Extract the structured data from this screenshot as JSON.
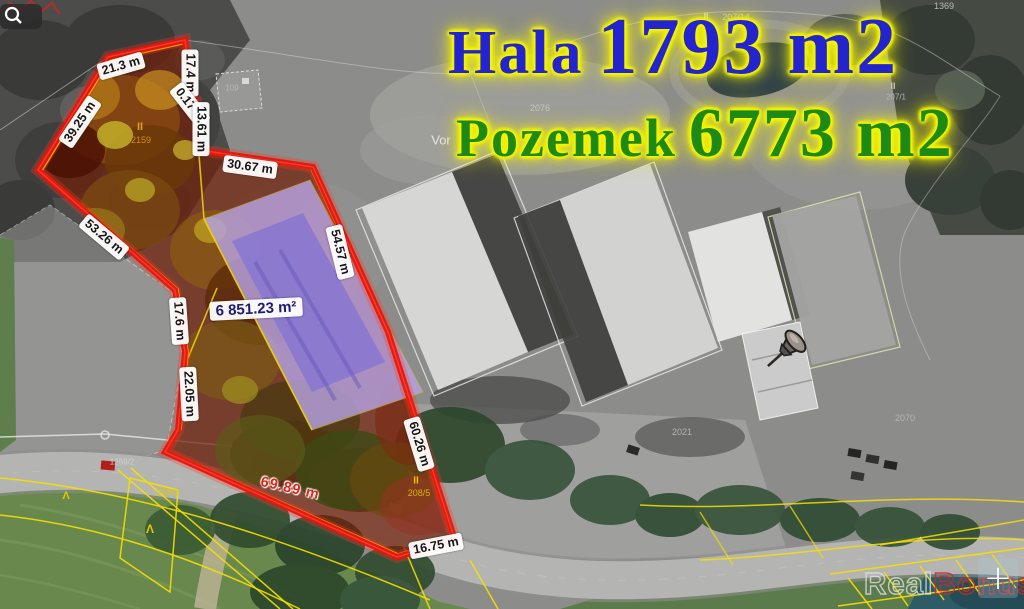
{
  "titles": {
    "hala_label": "Hala",
    "hala_value": "1793 m2",
    "pozemek_label": "Pozemek",
    "pozemek_value": "6773 m2"
  },
  "colors": {
    "hala_text": "#2424cf",
    "pozemek_text": "#1e8a16",
    "title_glow": "#f6f600",
    "boundary_red": "#e8140c",
    "cadastral_yellow": "#f5e000",
    "building_overlay_light": "#b6a2e2",
    "building_overlay_dark": "#8a78d0",
    "water_teal": "#2d5c66",
    "watermark_red": "#ce2824",
    "watermark_blue": "#2e60ba"
  },
  "measurements": [
    {
      "label": "21.3 m",
      "x": 121,
      "y": 66,
      "rot": -16,
      "style": "box"
    },
    {
      "label": "17.4 m",
      "x": 190,
      "y": 73,
      "rot": 90,
      "style": "box"
    },
    {
      "label": "0.17 m",
      "x": 190,
      "y": 105,
      "rot": 52,
      "style": "box"
    },
    {
      "label": "13.61 m",
      "x": 201,
      "y": 129,
      "rot": 90,
      "style": "box"
    },
    {
      "label": "39.25 m",
      "x": 80,
      "y": 122,
      "rot": -56,
      "style": "box"
    },
    {
      "label": "53.26 m",
      "x": 104,
      "y": 237,
      "rot": 40,
      "style": "box"
    },
    {
      "label": "30.67 m",
      "x": 250,
      "y": 167,
      "rot": 8,
      "style": "box"
    },
    {
      "label": "54.57 m",
      "x": 340,
      "y": 252,
      "rot": 76,
      "style": "box"
    },
    {
      "label": "17.6 m",
      "x": 179,
      "y": 321,
      "rot": 86,
      "style": "box"
    },
    {
      "label": "22.05 m",
      "x": 189,
      "y": 394,
      "rot": 87,
      "style": "box"
    },
    {
      "label": "60.26 m",
      "x": 419,
      "y": 444,
      "rot": 73,
      "style": "box"
    },
    {
      "label": "16.75 m",
      "x": 436,
      "y": 546,
      "rot": -11,
      "style": "box"
    },
    {
      "label": "69.89 m",
      "x": 290,
      "y": 489,
      "rot": 13,
      "style": "red"
    },
    {
      "label": "6 851.23 m²",
      "x": 256,
      "y": 309,
      "rot": -3,
      "style": "area"
    }
  ],
  "cadastral_labels": [
    {
      "text": "II",
      "x": 140,
      "y": 127,
      "color": "#e2a01a",
      "size": 11,
      "bold": true
    },
    {
      "text": "2159",
      "x": 141,
      "y": 140,
      "color": "#cc8c12",
      "size": 9,
      "bold": false
    },
    {
      "text": "II",
      "x": 706,
      "y": 16,
      "color": "#d8d8d6",
      "size": 9,
      "bold": true
    },
    {
      "text": "207/14",
      "x": 736,
      "y": 17,
      "color": "#c8c8c6",
      "size": 9,
      "bold": false
    },
    {
      "text": "1369",
      "x": 944,
      "y": 6,
      "color": "#b8b8b6",
      "size": 9,
      "bold": false
    },
    {
      "text": "II",
      "x": 893,
      "y": 86,
      "color": "#c8c8c6",
      "size": 9,
      "bold": true
    },
    {
      "text": "207/1",
      "x": 896,
      "y": 97,
      "color": "#b8b8b6",
      "size": 8,
      "bold": false
    },
    {
      "text": "109",
      "x": 232,
      "y": 88,
      "color": "#b8b8b6",
      "size": 8,
      "bold": false
    },
    {
      "text": "2076",
      "x": 540,
      "y": 108,
      "color": "#c6c6c4",
      "size": 9,
      "bold": false
    },
    {
      "text": "Vor",
      "x": 441,
      "y": 140,
      "color": "#e6e6e4",
      "size": 13,
      "bold": false
    },
    {
      "text": "II",
      "x": 416,
      "y": 481,
      "color": "#e8c400",
      "size": 10,
      "bold": true
    },
    {
      "text": "208/5",
      "x": 419,
      "y": 493,
      "color": "#d8b400",
      "size": 9,
      "bold": false
    },
    {
      "text": "208/2",
      "x": 168,
      "y": 492,
      "color": "#e0c800",
      "size": 9,
      "bold": false
    },
    {
      "text": "1269/2",
      "x": 122,
      "y": 462,
      "color": "#d0d0ce",
      "size": 8,
      "bold": false
    },
    {
      "text": "Λ",
      "x": 150,
      "y": 529,
      "color": "#e0c800",
      "size": 12,
      "bold": true
    },
    {
      "text": "Λ",
      "x": 66,
      "y": 496,
      "color": "#e0c800",
      "size": 11,
      "bold": true
    },
    {
      "text": "2021",
      "x": 682,
      "y": 432,
      "color": "#b4b4b2",
      "size": 9,
      "bold": false
    },
    {
      "text": "2070",
      "x": 905,
      "y": 418,
      "color": "#b4b4b2",
      "size": 9,
      "bold": false
    }
  ],
  "watermark": {
    "real": "Real",
    "bonus": "Bonus",
    "cz": ".cz"
  },
  "controls": {
    "zoom_in_label": "+"
  }
}
